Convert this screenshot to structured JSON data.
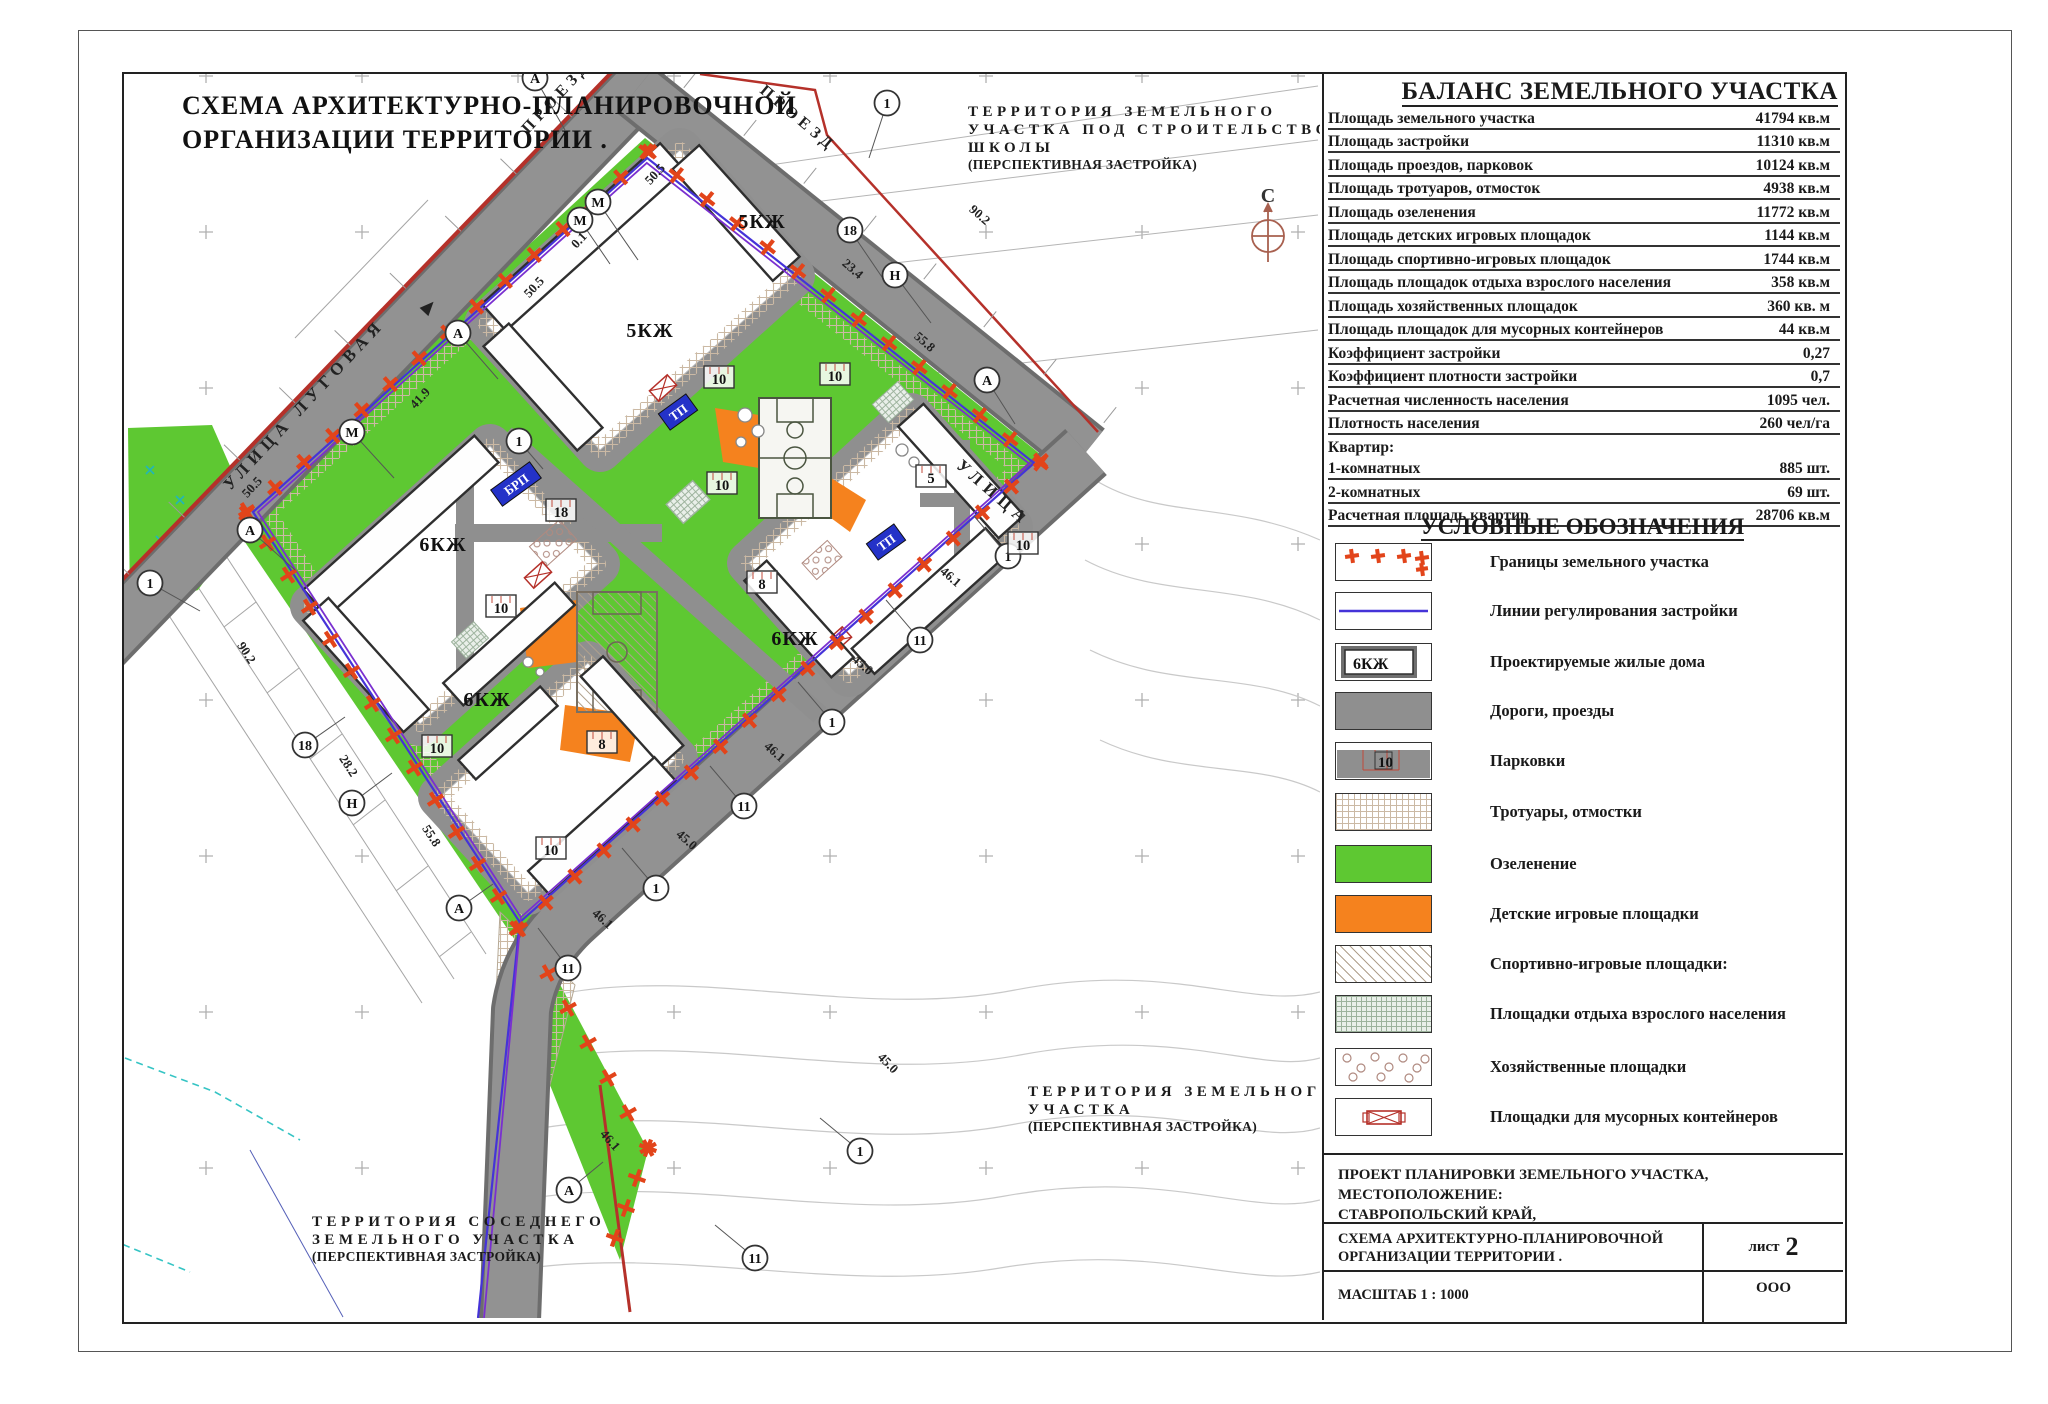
{
  "sheet": {
    "map_title": [
      "СХЕМА АРХИТЕКТУРНО-ПЛАНИРОВОЧНОЙ",
      "ОРГАНИЗАЦИИ ТЕРРИТОРИИ ."
    ],
    "north_label": "С"
  },
  "map": {
    "streets": [
      {
        "label": "УЛИЦА ЛУГОВАЯ",
        "x": 308,
        "y": 408,
        "r": -47,
        "fs": 17,
        "ls": 6
      },
      {
        "label": "ПРОЕЗД",
        "x": 560,
        "y": 100,
        "r": -47,
        "fs": 16,
        "ls": 5
      },
      {
        "label": "ПРОЕЗД",
        "x": 795,
        "y": 122,
        "r": 40,
        "fs": 16,
        "ls": 5
      },
      {
        "label": "УЛИЦА",
        "x": 990,
        "y": 497,
        "r": 41,
        "fs": 17,
        "ls": 6
      }
    ],
    "territories": {
      "school": [
        "ТЕРРИТОРИЯ ЗЕМЕЛЬНОГО",
        "УЧАСТКА ПОД СТРОИТЕЛЬСТВО",
        "ШКОЛЫ",
        "(ПЕРСПЕКТИВНАЯ ЗАСТРОЙКА)"
      ],
      "south": [
        "ТЕРРИТОРИЯ ЗЕМЕЛЬНОГО",
        "УЧАСТКА",
        "(ПЕРСПЕКТИВНАЯ ЗАСТРОЙКА)"
      ],
      "neighbor": [
        "ТЕРРИТОРИЯ СОСЕДНЕГО",
        "ЗЕМЕЛЬНОГО УЧАСТКА",
        "(ПЕРСПЕКТИВНАЯ ЗАСТРОЙКА)"
      ]
    },
    "building_labels": [
      {
        "t": "5КЖ",
        "x": 762,
        "y": 228
      },
      {
        "t": "5КЖ",
        "x": 650,
        "y": 337
      },
      {
        "t": "6КЖ",
        "x": 443,
        "y": 551
      },
      {
        "t": "6КЖ",
        "x": 487,
        "y": 706
      },
      {
        "t": "6КЖ",
        "x": 795,
        "y": 645
      }
    ],
    "utility_labels": [
      {
        "t": "БРП",
        "x": 516,
        "y": 484,
        "w": 48
      },
      {
        "t": "ТП",
        "x": 678,
        "y": 412,
        "w": 34
      },
      {
        "t": "ТП",
        "x": 886,
        "y": 542,
        "w": 34
      }
    ],
    "parking_labels": [
      {
        "t": "10",
        "x": 719,
        "y": 377
      },
      {
        "t": "10",
        "x": 835,
        "y": 374
      },
      {
        "t": "10",
        "x": 722,
        "y": 483
      },
      {
        "t": "10",
        "x": 501,
        "y": 606
      },
      {
        "t": "10",
        "x": 551,
        "y": 848
      },
      {
        "t": "10",
        "x": 437,
        "y": 746
      },
      {
        "t": "10",
        "x": 1023,
        "y": 543
      },
      {
        "t": "18",
        "x": 561,
        "y": 510
      },
      {
        "t": "5",
        "x": 931,
        "y": 476
      },
      {
        "t": "8",
        "x": 762,
        "y": 582
      },
      {
        "t": "8",
        "x": 602,
        "y": 742
      }
    ],
    "axis_markers": [
      {
        "t": "А",
        "x": 535,
        "y": 78,
        "lx": 30,
        "ly": 52
      },
      {
        "t": "1",
        "x": 887,
        "y": 103,
        "lx": -18,
        "ly": 55
      },
      {
        "t": "М",
        "x": 598,
        "y": 202,
        "lx": 40,
        "ly": 58
      },
      {
        "t": "М",
        "x": 580,
        "y": 220,
        "lx": 30,
        "ly": 44
      },
      {
        "t": "А",
        "x": 458,
        "y": 333,
        "lx": 40,
        "ly": 46
      },
      {
        "t": "М",
        "x": 352,
        "y": 432,
        "lx": 42,
        "ly": 46
      },
      {
        "t": "А",
        "x": 250,
        "y": 530,
        "lx": 45,
        "ly": 40
      },
      {
        "t": "1",
        "x": 150,
        "y": 583,
        "lx": 50,
        "ly": 28
      },
      {
        "t": "18",
        "x": 850,
        "y": 230,
        "lx": 34,
        "ly": 50
      },
      {
        "t": "Н",
        "x": 895,
        "y": 275,
        "lx": 36,
        "ly": 48
      },
      {
        "t": "А",
        "x": 987,
        "y": 380,
        "lx": 28,
        "ly": 44
      },
      {
        "t": "1",
        "x": 519,
        "y": 441,
        "lx": 24,
        "ly": 28
      },
      {
        "t": "1",
        "x": 1008,
        "y": 556,
        "lx": -34,
        "ly": -40
      },
      {
        "t": "11",
        "x": 920,
        "y": 640,
        "lx": -34,
        "ly": -40
      },
      {
        "t": "1",
        "x": 832,
        "y": 722,
        "lx": -34,
        "ly": -40
      },
      {
        "t": "11",
        "x": 744,
        "y": 806,
        "lx": -34,
        "ly": -40
      },
      {
        "t": "1",
        "x": 656,
        "y": 888,
        "lx": -34,
        "ly": -40
      },
      {
        "t": "11",
        "x": 568,
        "y": 968,
        "lx": -30,
        "ly": -40
      },
      {
        "t": "18",
        "x": 305,
        "y": 745,
        "lx": 40,
        "ly": -28
      },
      {
        "t": "Н",
        "x": 352,
        "y": 803,
        "lx": 40,
        "ly": -30
      },
      {
        "t": "А",
        "x": 459,
        "y": 908,
        "lx": 34,
        "ly": -24
      },
      {
        "t": "1",
        "x": 860,
        "y": 1151,
        "lx": -40,
        "ly": -33
      },
      {
        "t": "А",
        "x": 569,
        "y": 1190,
        "lx": 34,
        "ly": -28
      },
      {
        "t": "11",
        "x": 755,
        "y": 1258,
        "lx": -40,
        "ly": -33
      }
    ],
    "dimensions": [
      {
        "t": "50.5",
        "x": 658,
        "y": 177,
        "r": -47
      },
      {
        "t": "0.1",
        "x": 582,
        "y": 243,
        "r": -47
      },
      {
        "t": "50.5",
        "x": 537,
        "y": 290,
        "r": -47
      },
      {
        "t": "41.9",
        "x": 423,
        "y": 401,
        "r": -47
      },
      {
        "t": "50.5",
        "x": 255,
        "y": 490,
        "r": -47
      },
      {
        "t": "90.2",
        "x": 977,
        "y": 218,
        "r": 41
      },
      {
        "t": "23.4",
        "x": 850,
        "y": 272,
        "r": 41
      },
      {
        "t": "55.8",
        "x": 922,
        "y": 345,
        "r": 41
      },
      {
        "t": "90.2",
        "x": 243,
        "y": 655,
        "r": 57
      },
      {
        "t": "28.2",
        "x": 345,
        "y": 768,
        "r": 57
      },
      {
        "t": "55.8",
        "x": 428,
        "y": 838,
        "r": 57
      },
      {
        "t": "46.1",
        "x": 948,
        "y": 580,
        "r": 41
      },
      {
        "t": "45.0",
        "x": 860,
        "y": 668,
        "r": 41
      },
      {
        "t": "46.1",
        "x": 772,
        "y": 755,
        "r": 41
      },
      {
        "t": "45.0",
        "x": 684,
        "y": 843,
        "r": 41
      },
      {
        "t": "46.1",
        "x": 600,
        "y": 922,
        "r": 41
      },
      {
        "t": "45.0",
        "x": 885,
        "y": 1066,
        "r": 45
      },
      {
        "t": "46.1",
        "x": 607,
        "y": 1143,
        "r": 49
      }
    ]
  },
  "balance_table": {
    "title": "БАЛАНС ЗЕМЕЛЬНОГО УЧАСТКА",
    "rows": [
      {
        "label": "Площадь земельного участка",
        "value": "41794 кв.м"
      },
      {
        "label": "Площадь застройки",
        "value": "11310 кв.м"
      },
      {
        "label": "Площадь проездов, парковок",
        "value": "10124 кв.м"
      },
      {
        "label": "Площадь тротуаров, отмосток",
        "value": "4938 кв.м"
      },
      {
        "label": "Площадь озеленения",
        "value": "11772 кв.м"
      },
      {
        "label": "Площадь детских игровых площадок",
        "value": "1144 кв.м"
      },
      {
        "label": "Площадь спортивно-игровых площадок",
        "value": "1744 кв.м"
      },
      {
        "label": "Площадь площадок отдыха взрослого населения",
        "value": "358 кв.м"
      },
      {
        "label": "Площадь хозяйственных площадок",
        "value": "360 кв. м"
      },
      {
        "label": "Площадь площадок для мусорных контейнеров",
        "value": "44 кв.м"
      },
      {
        "label": "Коэффициент застройки",
        "value": "0,27"
      },
      {
        "label": "Коэффициент плотности застройки",
        "value": "0,7"
      },
      {
        "label": "Расчетная численность населения",
        "value": "1095 чел."
      },
      {
        "label": "Плотность населения",
        "value": "260 чел/га"
      },
      {
        "label": "Квартир:",
        "value": "",
        "header_only": true
      },
      {
        "label": "1-комнатных",
        "value": "885 шт."
      },
      {
        "label": "2-комнатных",
        "value": "69 шт."
      },
      {
        "label": "Расчетная площадь квартир",
        "value": "28706 кв.м"
      }
    ]
  },
  "legend": {
    "title": "УСЛОВНЫЕ ОБОЗНАЧЕНИЯ",
    "items": [
      {
        "label": "Границы земельного участка",
        "type": "boundary"
      },
      {
        "label": "Линии регулирования застройки",
        "type": "regulation-line"
      },
      {
        "label": "Проектируемые жилые дома",
        "type": "house",
        "symbol_text": "6КЖ"
      },
      {
        "label": "Дороги, проезды",
        "type": "road"
      },
      {
        "label": "Парковки",
        "type": "parking",
        "symbol_text": "10"
      },
      {
        "label": "Тротуары, отмостки",
        "type": "sidewalk"
      },
      {
        "label": "Озеленение",
        "type": "greenery"
      },
      {
        "label": "Детские игровые площадки",
        "type": "playground"
      },
      {
        "label": "Спортивно-игровые площадки:",
        "type": "sport"
      },
      {
        "label": "Площадки отдыха взрослого населения",
        "type": "rest"
      },
      {
        "label": "Хозяйственные площадки",
        "type": "household"
      },
      {
        "label": "Площадки для мусорных контейнеров",
        "type": "trash"
      }
    ]
  },
  "title_block": {
    "project_location_line1": "ПРОЕКТ ПЛАНИРОВКИ ЗЕМЕЛЬНОГО УЧАСТКА, МЕСТОПОЛОЖЕНИЕ:",
    "project_location_line2": "СТАВРОПОЛЬСКИЙ КРАЙ,",
    "scheme_name_line1": "СХЕМА АРХИТЕКТУРНО-ПЛАНИРОВОЧНОЙ",
    "scheme_name_line2": "ОРГАНИЗАЦИИ ТЕРРИТОРИИ .",
    "sheet_label": "лист",
    "sheet_number": "2",
    "scale_label": "МАСШТАБ 1 : 1000",
    "organization": "ООО"
  },
  "colors": {
    "greenery": "#5ec832",
    "playground_orange": "#f5821e",
    "road_gray": "#8f8f8f",
    "boundary_red": "#e2441a",
    "regulation_blue": "#4533d8",
    "regulation_purple": "#7a2fd0",
    "street_red_line": "#b5312a"
  }
}
